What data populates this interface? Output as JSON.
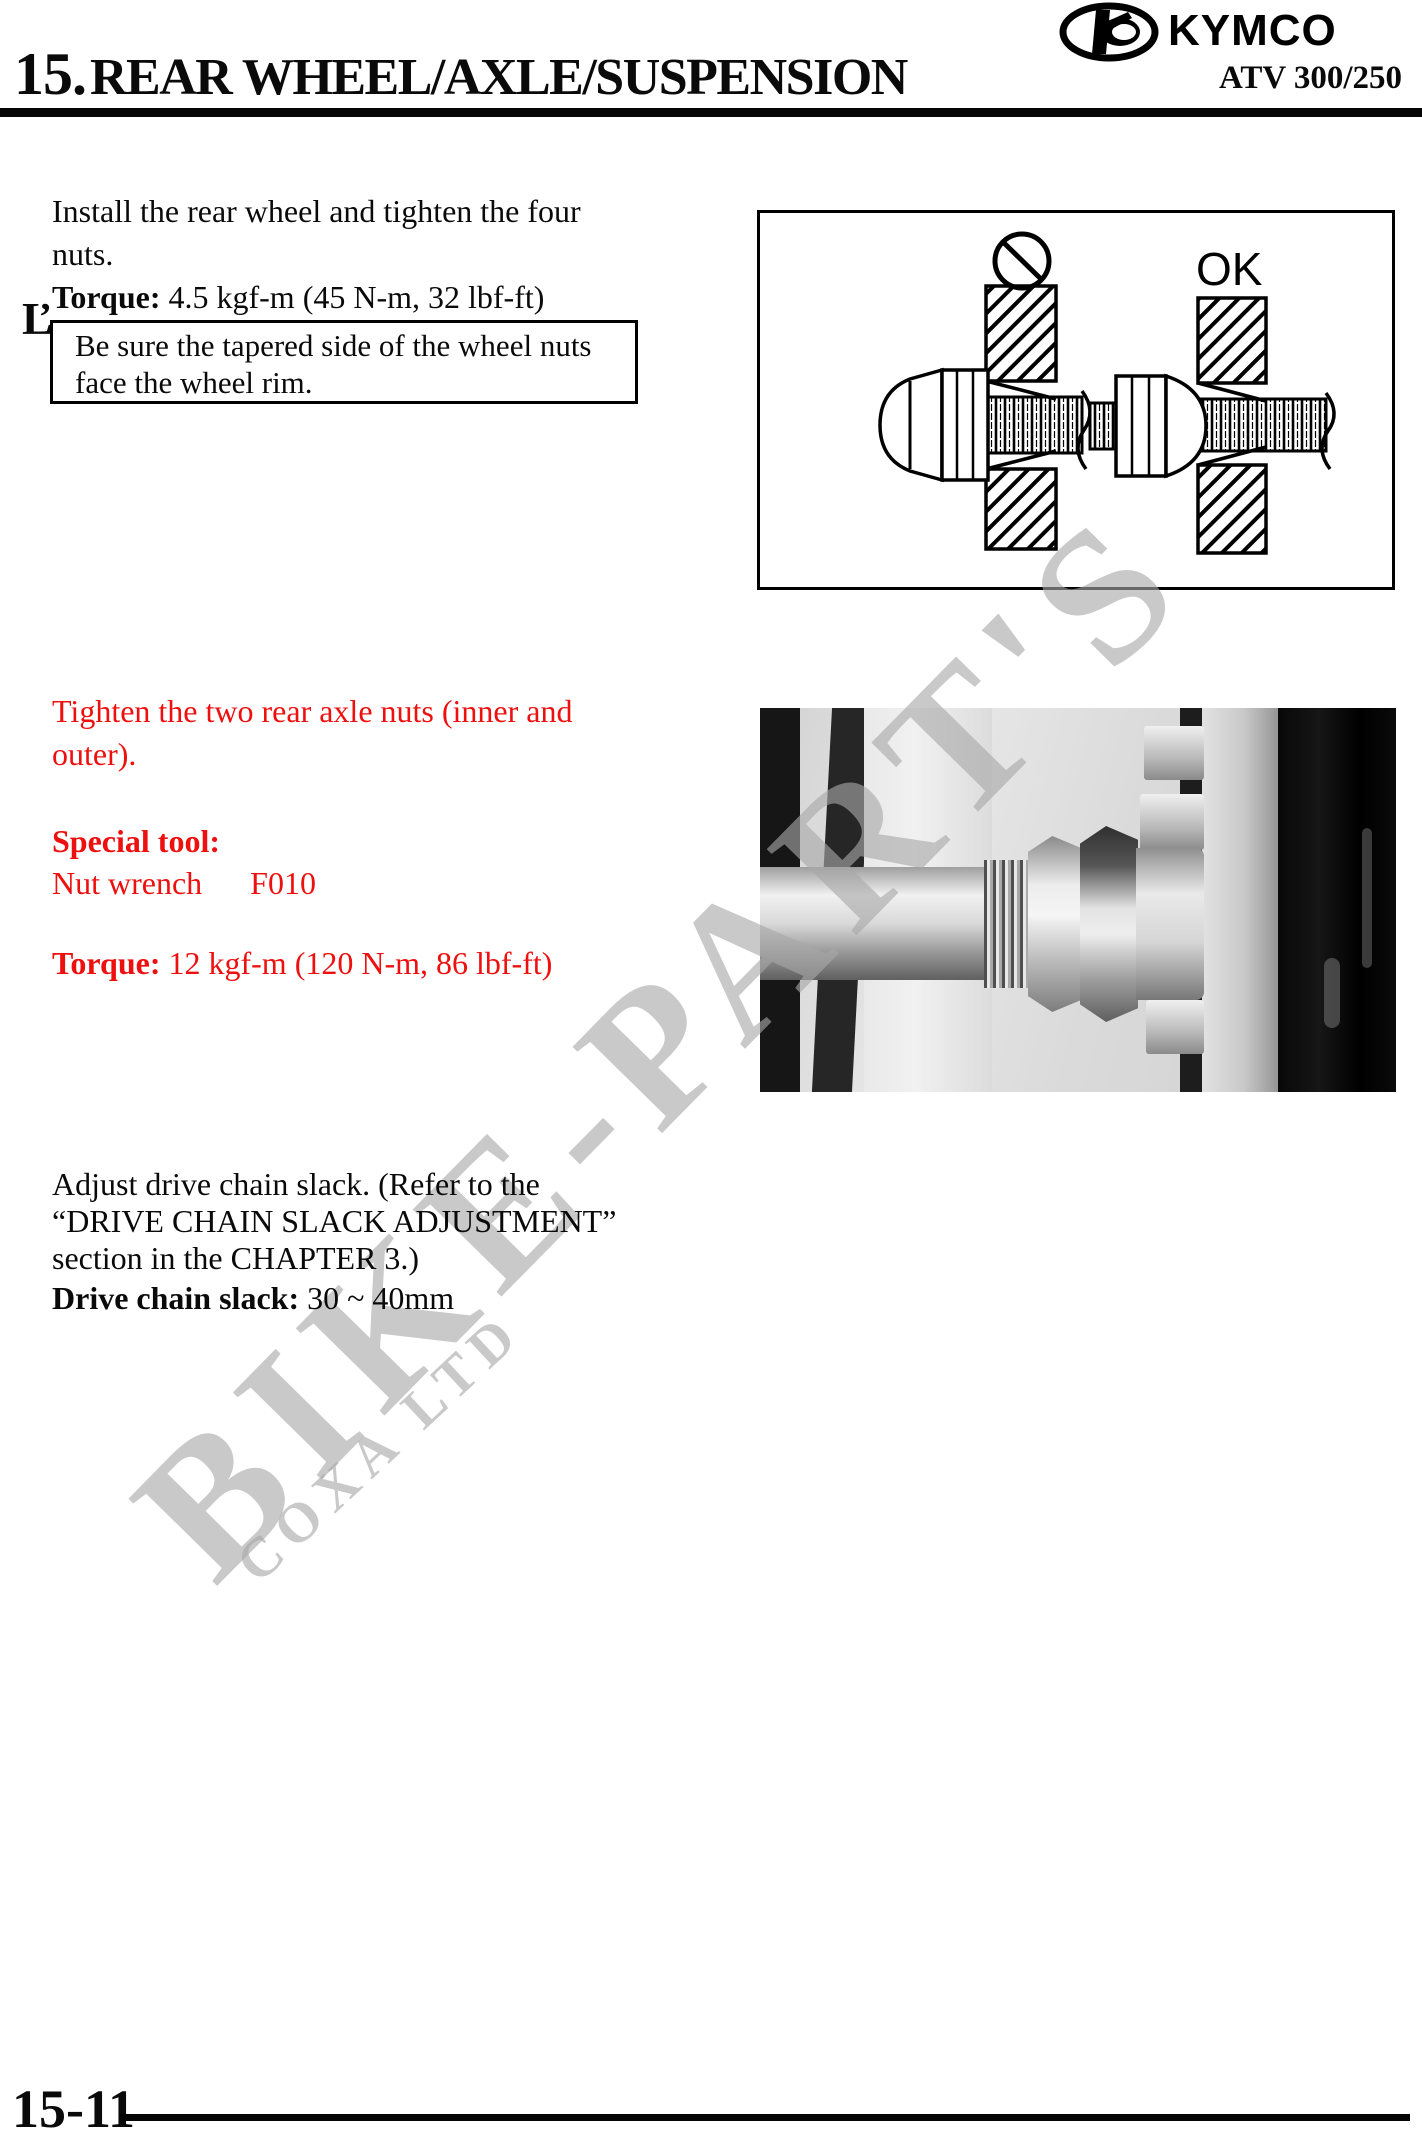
{
  "header": {
    "chapter_number": "15.",
    "chapter_title": "REAR WHEEL/AXLE/SUSPENSION",
    "brand": "KYMCO",
    "model": "ATV 300/250"
  },
  "install_step": {
    "line1": "Install the rear wheel and tighten the four",
    "line2": "nuts.",
    "torque_label": "Torque:",
    "torque_value": "4.5 kgf-m (45 N-m, 32 lbf-ft)"
  },
  "note": {
    "marker": "Ľ",
    "line1": "Be sure the tapered side of the wheel nuts",
    "line2": "face the wheel rim."
  },
  "diagram": {
    "ok_label": "OK"
  },
  "axle_step": {
    "line1": "Tighten the two rear axle nuts (inner and",
    "line2": "outer).",
    "special_tool_label": "Special tool:",
    "tool_name": "Nut wrench",
    "tool_code": "F010",
    "torque_label": "Torque:",
    "torque_value": "12 kgf-m (120 N-m, 86 lbf-ft)",
    "accent_color": "#ee0f0f"
  },
  "chain_step": {
    "line1": "Adjust drive chain slack. (Refer to the",
    "line2": "“DRIVE CHAIN SLACK ADJUSTMENT”",
    "line3": "section in the CHAPTER 3.)",
    "slack_label": "Drive chain slack:",
    "slack_value": "30 ~ 40mm"
  },
  "watermark": {
    "text": "BIKE-PART'S",
    "subtext": "COXA LTD",
    "color": "#c8c8c8"
  },
  "footer": {
    "page_number": "15-11"
  }
}
